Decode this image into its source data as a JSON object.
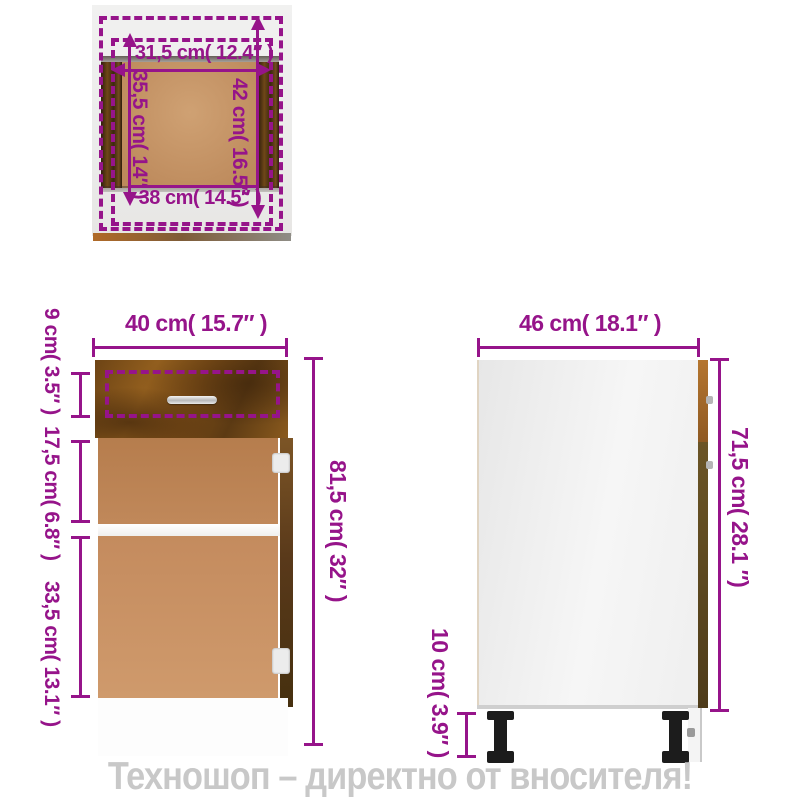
{
  "colors": {
    "accent": "#96148a",
    "bannerGray": "#c8c8c8",
    "woodDark": "#6d4415",
    "woodTan": "#c08557",
    "legBlack": "#1c1c1c"
  },
  "banner": {
    "text": "Техношоп – директно от вносителя!"
  },
  "top_view": {
    "inner_width": "31,5 cm( 12.4″ )",
    "inner_depth": "35,5 cm( 14″ )",
    "outer_depth": "42 cm( 16.5″ )",
    "outer_width": "38 cm( 14.5″ )"
  },
  "front_view": {
    "width": "40 cm( 15.7″ )",
    "drawer_height": "9 cm( 3.5″ )",
    "upper_section": "17,5 cm( 6.8″ )",
    "lower_section": "33,5 cm( 13.1″ )",
    "total_height": "81,5 cm( 32″ )"
  },
  "side_view": {
    "depth": "46 cm( 18.1″ )",
    "body_height": "71,5 cm( 28.1 ″)",
    "leg_height": "10 cm( 3.9″ )"
  }
}
